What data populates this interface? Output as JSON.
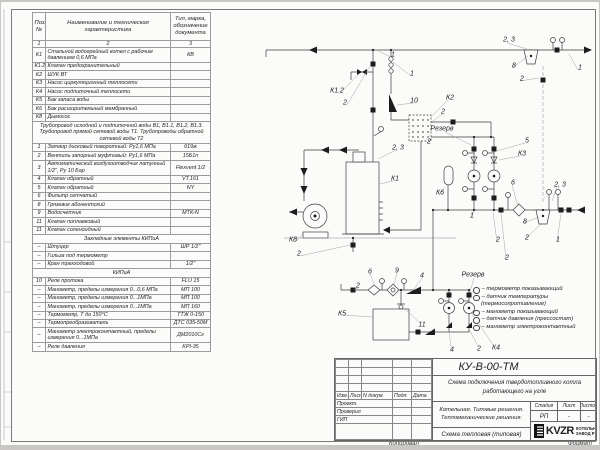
{
  "spec_table": {
    "headers": {
      "pos": "Поз.\n№",
      "name": "Наименование и техническая характеристика",
      "type": "Тип, марка, обозначение документа"
    },
    "col_numbers": [
      "1",
      "2",
      "3"
    ],
    "rows": [
      {
        "pos": "К1",
        "name": "Стальной водогрейный котел с рабочим давлением 0,6 МПа",
        "type": "КВ"
      },
      {
        "pos": "К1.2",
        "name": "Клапан предохранительный",
        "type": ""
      },
      {
        "pos": "К2",
        "name": "ШУК ВТ",
        "type": ""
      },
      {
        "pos": "К3",
        "name": "Насос циркуляционный теплосети",
        "type": ""
      },
      {
        "pos": "К4",
        "name": "Насос подпиточный теплосети",
        "type": ""
      },
      {
        "pos": "К5",
        "name": "Бак запаса воды",
        "type": ""
      },
      {
        "pos": "К6",
        "name": "Бак расширительный мембранный",
        "type": ""
      },
      {
        "pos": "К8",
        "name": "Дымосос",
        "type": ""
      },
      {
        "span": "Трубопровод исходной и подпиточной воды В1, В1.1, В1.2, В1.3. Трубопровод прямой сетевой воды Т1. Трубопроводы обратной сетевой воды Т2"
      },
      {
        "pos": "1",
        "name": "Затвор дисковый поворотный: Ру1,6 МПа",
        "type": "б19ж"
      },
      {
        "pos": "2",
        "name": "Вентиль запорный муфтовый: Ру1,6 МПа",
        "type": "15Б1п"
      },
      {
        "pos": "3",
        "name": "Автоматический воздухоотводчик латунный 1/2\", Ру 10 Бар",
        "type": "Flexvent 1/2"
      },
      {
        "pos": "4",
        "name": "Клапан обратный",
        "type": "VT.161"
      },
      {
        "pos": "5",
        "name": "Клапан обратный",
        "type": "NY"
      },
      {
        "pos": "6",
        "name": "Фильтр сетчатый",
        "type": ""
      },
      {
        "pos": "8",
        "name": "Грязевик абонентский",
        "type": ""
      },
      {
        "pos": "9",
        "name": "Водосчетчик",
        "type": "МТК-N"
      },
      {
        "pos": "11",
        "name": "Клапан поплавковый",
        "type": ""
      },
      {
        "pos": "11",
        "name": "Клапан соленоидный",
        "type": ""
      },
      {
        "section": "Закладные элементы КИПиА"
      },
      {
        "pos": "–",
        "name": "Штуцер",
        "type": "ШР 1/2\""
      },
      {
        "pos": "–",
        "name": "Гильза под термометр",
        "type": ""
      },
      {
        "pos": "–",
        "name": "Кран трехходовой",
        "type": "1/2\""
      },
      {
        "section": "КИПиА"
      },
      {
        "pos": "10",
        "name": "Реле протока",
        "type": "FLU 15"
      },
      {
        "pos": "–",
        "name": "Манометр, пределы измерения 0...0,6 МПа",
        "type": "МП 100"
      },
      {
        "pos": "–",
        "name": "Манометр, пределы измерения 0...1МПа",
        "type": "МП 100"
      },
      {
        "pos": "–",
        "name": "Манометр, пределы измерения 0...1МПа",
        "type": "МП 160"
      },
      {
        "pos": "–",
        "name": "Термометр, Т до 150°С",
        "type": "ТТЖ 0-150"
      },
      {
        "pos": "–",
        "name": "Термопреобразователь",
        "type": "ДТС 035-50М"
      },
      {
        "pos": "–",
        "name": "Манометр электроконтактный, пределы измерения 0...1МПа",
        "type": "ДМ2010Сг"
      },
      {
        "pos": "–",
        "name": "Реле давления",
        "type": "KPI-35"
      }
    ]
  },
  "diagram": {
    "labels": [
      {
        "t": "1",
        "x": 392,
        "y": 53
      },
      {
        "t": "2, 3",
        "x": 508,
        "y": 38
      },
      {
        "t": "8",
        "x": 513,
        "y": 64
      },
      {
        "t": "2",
        "x": 521,
        "y": 77
      },
      {
        "t": "1",
        "x": 579,
        "y": 66
      },
      {
        "t": "К1.2",
        "x": 336,
        "y": 89
      },
      {
        "t": "2",
        "x": 344,
        "y": 101
      },
      {
        "t": "1",
        "x": 411,
        "y": 72
      },
      {
        "t": "10",
        "x": 413,
        "y": 99
      },
      {
        "t": "К2",
        "x": 449,
        "y": 96
      },
      {
        "t": "2",
        "x": 442,
        "y": 110
      },
      {
        "t": "Резерв",
        "x": 441,
        "y": 127
      },
      {
        "t": "2",
        "x": 428,
        "y": 140
      },
      {
        "t": "2, 3",
        "x": 397,
        "y": 146
      },
      {
        "t": "К1",
        "x": 394,
        "y": 177
      },
      {
        "t": "5",
        "x": 526,
        "y": 139
      },
      {
        "t": "К3",
        "x": 521,
        "y": 152
      },
      {
        "t": "К6",
        "x": 439,
        "y": 191
      },
      {
        "t": "6",
        "x": 512,
        "y": 181
      },
      {
        "t": "2, 3",
        "x": 559,
        "y": 183
      },
      {
        "t": "1",
        "x": 471,
        "y": 214
      },
      {
        "t": "8",
        "x": 524,
        "y": 220
      },
      {
        "t": "2",
        "x": 497,
        "y": 238
      },
      {
        "t": "2",
        "x": 526,
        "y": 236
      },
      {
        "t": "1",
        "x": 557,
        "y": 238
      },
      {
        "t": "К8",
        "x": 292,
        "y": 238
      },
      {
        "t": "2",
        "x": 298,
        "y": 252
      },
      {
        "t": "2",
        "x": 357,
        "y": 284
      },
      {
        "t": "6",
        "x": 369,
        "y": 270
      },
      {
        "t": "9",
        "x": 396,
        "y": 269
      },
      {
        "t": "4",
        "x": 421,
        "y": 274
      },
      {
        "t": "К5",
        "x": 341,
        "y": 312
      },
      {
        "t": "11",
        "x": 421,
        "y": 323
      },
      {
        "t": "4",
        "x": 451,
        "y": 348
      },
      {
        "t": "2",
        "x": 478,
        "y": 347
      },
      {
        "t": "К4",
        "x": 495,
        "y": 346
      },
      {
        "t": "Резерв",
        "x": 472,
        "y": 273
      },
      {
        "t": "2",
        "x": 506,
        "y": 256
      }
    ],
    "legend": {
      "items": [
        {
          "label": "– термометр показывающий"
        },
        {
          "label": "– датчик температуры"
        },
        {
          "label": "(термосопротивление)",
          "cont": true
        },
        {
          "label": "– манометр показывающий"
        },
        {
          "label": "– датчик давления (прессостат)"
        },
        {
          "label": "– манометр электроконтактный"
        }
      ]
    }
  },
  "title_block": {
    "doc_code": "КУ-В-00-ТМ",
    "doc_title": "Схема подключения твердотопливного котла работающего на угле",
    "project_line1": "Котельная. Типовые решения.",
    "project_line2": "Тепломеханические решения.",
    "stage_header": "Стадия",
    "sheet_header": "Лист",
    "sheets_header": "Листов",
    "stage_value": "РП",
    "sheet_value": "-",
    "sheets_value": "-",
    "sheet_name": "Схема тепловая (типовая)",
    "logo_text": "KVZR",
    "company_line1": "КОТЕЛЬН",
    "company_line2": "ЗАВОД Р",
    "col_izm": "Изм.",
    "col_list": "Лист",
    "col_ndoc": "N докум.",
    "col_podp": "Подп.",
    "col_data": "Дата",
    "row_proekt": "Проект.",
    "row_proveril": "Проверил",
    "row_gip": "ГИП",
    "kopiroval": "Копировал",
    "format": "Формат"
  }
}
